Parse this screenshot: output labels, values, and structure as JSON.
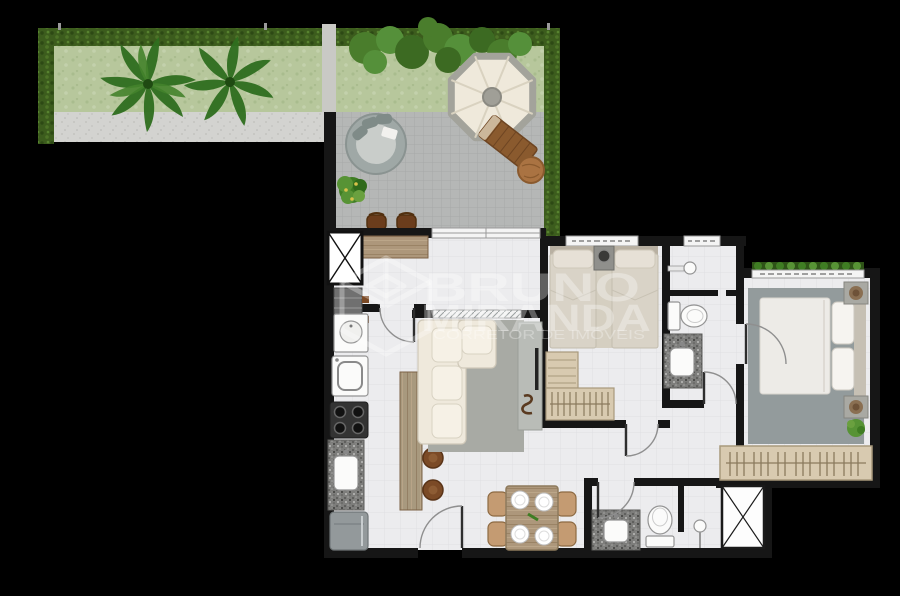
{
  "watermark": {
    "line1": "BRUNO",
    "line2": "MIRANDA",
    "tagline": "CORRETOR DE IMÓVEIS"
  },
  "palette": {
    "background": "#000000",
    "hedge": "#3c5c1d",
    "grass": "#b7c79c",
    "path_concrete": "#d3d3d0",
    "terrace_pavers": "#b5b7b6",
    "floor_tile": "#ececee",
    "wall": "#161616",
    "garden_wall": "#c9c9c5",
    "wood": "#ad977b",
    "granite": "#7d7d7b",
    "sofa_cream": "#efe9dc",
    "rug_living": "#a8aaa4",
    "rug_master": "#939b9c",
    "bedding_beige": "#d9d3c7",
    "wardrobe_tan": "#d8cab0",
    "furniture_brown": "#7b4a26",
    "umbrella_canopy": "#efe9db"
  },
  "outdoor": {
    "areas": [
      {
        "label": "garden-hedge-border"
      },
      {
        "label": "grass-lawn-with-two-palm-trees"
      },
      {
        "label": "shrub-row"
      },
      {
        "label": "concrete-path"
      },
      {
        "label": "paved-terrace"
      }
    ],
    "furniture": [
      {
        "label": "octagonal-parasol"
      },
      {
        "label": "round-daybed-sofa"
      },
      {
        "label": "wood-sun-lounger"
      },
      {
        "label": "round-pouf-table"
      },
      {
        "label": "potted-plant"
      },
      {
        "label": "two-bar-stools-at-outdoor-counter"
      }
    ]
  },
  "apartment": {
    "rooms": [
      {
        "label": "gourmet-balcony-with-counter"
      },
      {
        "label": "laundry-with-tank-and-washer"
      },
      {
        "label": "kitchen-with-stove-sink-fridge"
      },
      {
        "label": "living-room-with-l-sofa-and-tv-panel"
      },
      {
        "label": "dining-for-four"
      },
      {
        "label": "bedroom-twin-beds"
      },
      {
        "label": "suite-bathroom"
      },
      {
        "label": "master-bedroom-double-bed"
      },
      {
        "label": "social-bathroom-with-shower-box"
      },
      {
        "label": "elevator-shaft-marked-x"
      }
    ]
  }
}
